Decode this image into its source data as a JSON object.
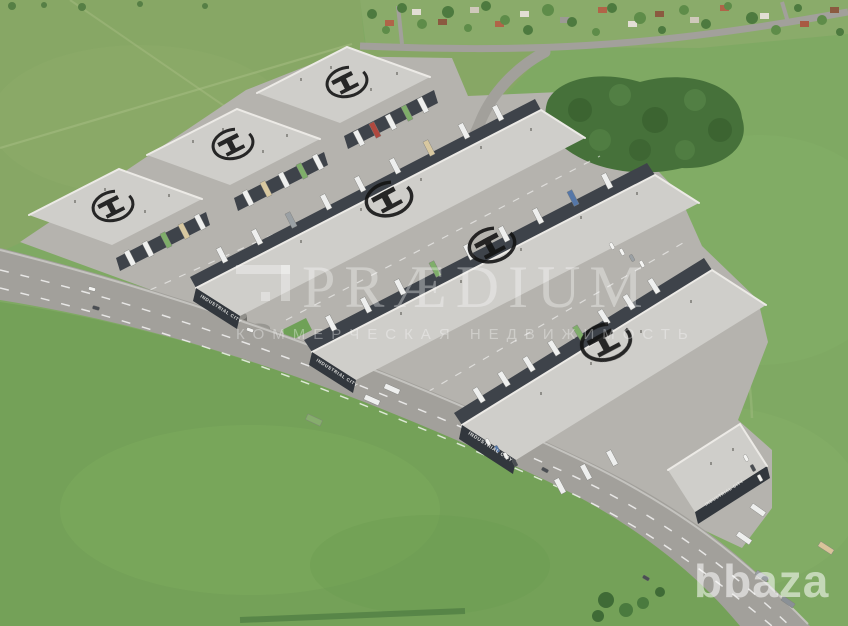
{
  "watermarks": {
    "agency": {
      "name": "PRÆDIUM",
      "tagline": "КОММЕРЧЕСКАЯ НЕДВИЖИМОСТЬ",
      "logo_icon": "praedium-logo-icon",
      "color": "#ffffff"
    },
    "listing_site": {
      "name": "bbaza",
      "color": "#ffffff"
    }
  },
  "park": {
    "facade_label": "INDUSTRIAL CITY",
    "roof_logo_icon": "industrial-city-ring-logo",
    "roof_logo_count": 6,
    "warehouse_count": 8
  },
  "palette": {
    "field_green": "#7fa963",
    "field_olive": "#87a765",
    "field_bottom": "#74a158",
    "village_green": "#8aab6a",
    "forest_green": "#46713a",
    "road_gray": "#a2a09b",
    "yard_gray": "#b5b3ae",
    "roof_light": "#cfceca",
    "facade_dark": "#3e434a",
    "logo_black": "#141414",
    "truck_white": "#eeefee"
  }
}
